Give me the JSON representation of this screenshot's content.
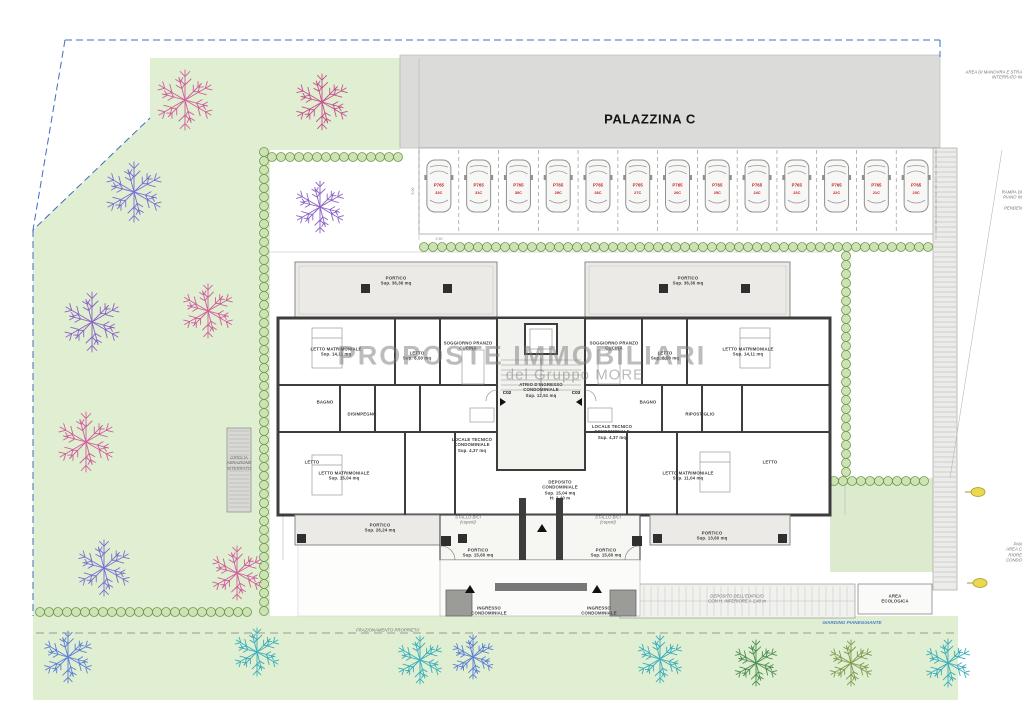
{
  "title": "PALAZZINA C",
  "watermark": {
    "line1": "PROPOSTE IMMOBILIARI",
    "line2": "del Gruppo MORE"
  },
  "parking": {
    "code": "P765",
    "stalls": [
      "32C",
      "31C",
      "30C",
      "29C",
      "28C",
      "27C",
      "26C",
      "25C",
      "24C",
      "23C",
      "22C",
      "21C",
      "20C"
    ]
  },
  "colors": {
    "pink": "#cf5f9b",
    "magenta": "#c4528d",
    "purple": "#8a63c5",
    "violet": "#7a6fd0",
    "blue": "#5b7fd4",
    "teal": "#3aaebb",
    "green": "#5da35d",
    "dkgreen": "#4c8f52",
    "olive": "#7f9c52",
    "garden": "#e0eed2",
    "hedge_fill": "#cde3b4",
    "hedge_stroke": "#6f9a4f",
    "wall": "#3d3d3d",
    "boundary_blue": "#3f6cc0",
    "parking_red": "#c22222",
    "asphalt": "#dbdbd9"
  },
  "labels": [
    {
      "t": "PORTICO\nSup. 36,36 mq",
      "x": 396,
      "y": 281,
      "c": "room",
      "n": "portico-top-left-label"
    },
    {
      "t": "PORTICO\nSup. 36,36 mq",
      "x": 688,
      "y": 281,
      "c": "room",
      "n": "portico-top-right-label"
    },
    {
      "t": "LETTO MATRIMONIALE\nSup. 14,11 mq",
      "x": 336,
      "y": 352,
      "c": "room",
      "n": "room-label"
    },
    {
      "t": "LETTO\nSup. 8,50 mq",
      "x": 417,
      "y": 356,
      "c": "room",
      "n": "room-label"
    },
    {
      "t": "SOGGIORNO PRANZO\nCUCINA",
      "x": 468,
      "y": 346,
      "c": "room",
      "n": "room-label"
    },
    {
      "t": "SOGGIORNO PRANZO\nCUCINA",
      "x": 614,
      "y": 346,
      "c": "room",
      "n": "room-label"
    },
    {
      "t": "LETTO MATRIMONIALE\nSup. 14,11 mq",
      "x": 748,
      "y": 352,
      "c": "room",
      "n": "room-label"
    },
    {
      "t": "LETTO\nSup. 8,50 mq",
      "x": 665,
      "y": 356,
      "c": "room",
      "n": "room-label"
    },
    {
      "t": "BAGNO",
      "x": 325,
      "y": 402,
      "c": "room",
      "n": "room-label"
    },
    {
      "t": "DISIMPEGNO",
      "x": 362,
      "y": 414,
      "c": "room",
      "n": "room-label"
    },
    {
      "t": "BAGNO",
      "x": 648,
      "y": 402,
      "c": "room",
      "n": "room-label"
    },
    {
      "t": "RIPOSTIGLIO",
      "x": 700,
      "y": 414,
      "c": "room",
      "n": "room-label"
    },
    {
      "t": "ATRIO D'INGRESSO\nCONDOMINIALE\nSup. 12,51 mq",
      "x": 541,
      "y": 390,
      "c": "room",
      "n": "atrium-label"
    },
    {
      "t": "LOCALE TECNICO\nCONDOMINIALE\nSup. 4,37 mq",
      "x": 472,
      "y": 445,
      "c": "room",
      "n": "room-label"
    },
    {
      "t": "LOCALE TECNICO\nCONDOMINIALE\nSup. 4,37 mq",
      "x": 612,
      "y": 432,
      "c": "room",
      "n": "room-label"
    },
    {
      "t": "DEPOSITO\nCONDOMINIALE\nSup. 15,04 mq\nH: 2,40 m",
      "x": 560,
      "y": 490,
      "c": "room",
      "n": "room-label"
    },
    {
      "t": "LETTO MATRIMONIALE\nSup. 15,04 mq",
      "x": 344,
      "y": 476,
      "c": "room",
      "n": "room-label"
    },
    {
      "t": "LETTO",
      "x": 312,
      "y": 462,
      "c": "room",
      "n": "room-label"
    },
    {
      "t": "LETTO MATRIMONIALE\nSup. 11,04 mq",
      "x": 688,
      "y": 476,
      "c": "room",
      "n": "room-label"
    },
    {
      "t": "LETTO",
      "x": 770,
      "y": 462,
      "c": "room",
      "n": "room-label"
    },
    {
      "t": "STALLO BICI\n(coperti)",
      "x": 468,
      "y": 520,
      "c": "ital",
      "n": "bike-stall-label"
    },
    {
      "t": "STALLO BICI\n(coperti)",
      "x": 608,
      "y": 520,
      "c": "ital",
      "n": "bike-stall-label"
    },
    {
      "t": "PORTICO\nSup. 15,60 mq",
      "x": 478,
      "y": 553,
      "c": "room",
      "n": "portico-label"
    },
    {
      "t": "PORTICO\nSup. 15,60 mq",
      "x": 606,
      "y": 553,
      "c": "room",
      "n": "portico-label"
    },
    {
      "t": "PORTICO\nSup. 26,24 mq",
      "x": 380,
      "y": 528,
      "c": "room",
      "n": "portico-label"
    },
    {
      "t": "PORTICO\nSup. 13,60 mq",
      "x": 712,
      "y": 536,
      "c": "room",
      "n": "portico-label"
    },
    {
      "t": "INGRESSO\nCONDOMINIALE",
      "x": 489,
      "y": 611,
      "c": "room",
      "n": "entrance-label"
    },
    {
      "t": "INGRESSO\nCONDOMINIALE",
      "x": 599,
      "y": 611,
      "c": "room",
      "n": "entrance-label"
    },
    {
      "t": "C02",
      "x": 507,
      "y": 393,
      "c": "code",
      "n": "door-code"
    },
    {
      "t": "C03",
      "x": 576,
      "y": 393,
      "c": "code",
      "n": "door-code"
    },
    {
      "t": "GRIGLIA\nAERAZIONE\nINTERRATO",
      "x": 239,
      "y": 463,
      "c": "ital",
      "n": "grille-label"
    },
    {
      "t": "AREA\nECOLOGICA",
      "x": 895,
      "y": 599,
      "c": "room",
      "n": "ecologic-area-label"
    },
    {
      "t": "DEPOSITO DELL'EDIFICIO\nCON H. INFERIORE A 2,40 m",
      "x": 737,
      "y": 599,
      "c": "ital",
      "n": "deposit-label"
    },
    {
      "t": "AREA DI MANOVRA E STRA\nINTERRATO IN",
      "x": 1024,
      "y": 75,
      "c": "ital rt",
      "n": "maneuver-area-label"
    },
    {
      "t": "RAMPA DI\nPIANO IN\n\nPENDEN",
      "x": 1024,
      "y": 200,
      "c": "ital rt",
      "n": "ramp-label"
    },
    {
      "t": "PAN\nAREA C\nRIORE\nCONDO",
      "x": 1024,
      "y": 552,
      "c": "ital rt",
      "n": "condominium-area-label"
    },
    {
      "t": "FRAZIONAMENTO PROPRIETA'",
      "x": 388,
      "y": 630,
      "c": "ital",
      "n": "property-split-label"
    },
    {
      "t": "GIARDINO PIANEGGIANTE",
      "x": 852,
      "y": 623,
      "c": "blue",
      "n": "garden-label"
    },
    {
      "t": "2,50",
      "x": 439,
      "y": 239,
      "c": "dim",
      "n": "dimension-text"
    },
    {
      "t": "5,00",
      "x": 413,
      "y": 191,
      "c": "vdim",
      "n": "dimension-text"
    }
  ],
  "trees": [
    {
      "x": 185,
      "y": 100,
      "r": 30,
      "c": "pink"
    },
    {
      "x": 322,
      "y": 102,
      "r": 28,
      "c": "magenta"
    },
    {
      "x": 134,
      "y": 192,
      "r": 30,
      "c": "violet"
    },
    {
      "x": 320,
      "y": 207,
      "r": 26,
      "c": "purple"
    },
    {
      "x": 92,
      "y": 322,
      "r": 30,
      "c": "purple"
    },
    {
      "x": 208,
      "y": 311,
      "r": 27,
      "c": "pink"
    },
    {
      "x": 86,
      "y": 442,
      "r": 30,
      "c": "pink"
    },
    {
      "x": 104,
      "y": 568,
      "r": 28,
      "c": "violet"
    },
    {
      "x": 237,
      "y": 573,
      "r": 27,
      "c": "pink"
    },
    {
      "x": 68,
      "y": 657,
      "r": 26,
      "c": "blue"
    },
    {
      "x": 257,
      "y": 652,
      "r": 24,
      "c": "teal"
    },
    {
      "x": 420,
      "y": 660,
      "r": 24,
      "c": "teal"
    },
    {
      "x": 473,
      "y": 657,
      "r": 22,
      "c": "blue"
    },
    {
      "x": 660,
      "y": 659,
      "r": 24,
      "c": "teal"
    },
    {
      "x": 756,
      "y": 663,
      "r": 23,
      "c": "dkgreen"
    },
    {
      "x": 851,
      "y": 663,
      "r": 23,
      "c": "olive"
    },
    {
      "x": 948,
      "y": 663,
      "r": 24,
      "c": "teal"
    }
  ]
}
